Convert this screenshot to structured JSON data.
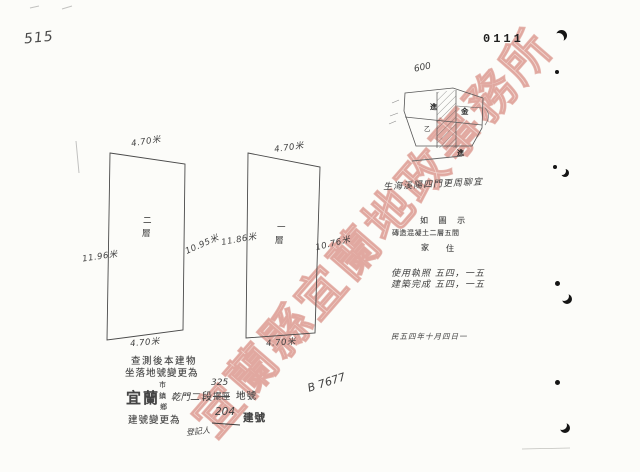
{
  "page": {
    "sheet_number": "515",
    "stamp_number": "0111",
    "ink_color": "#3a3a3a"
  },
  "watermark": {
    "text": "宜蘭縣宜蘭地政事務所",
    "color": "#d98c80"
  },
  "floor_plans": {
    "left": {
      "floor_chars": [
        "二",
        "層"
      ],
      "top": "4.70米",
      "left_side": "11.96米",
      "right_side": "10.95米",
      "bottom": "4.70米"
    },
    "right": {
      "floor_chars": [
        "一",
        "層"
      ],
      "top": "4.70米",
      "left_side": "11.86米",
      "right_side": "10.76米",
      "bottom": "4.70米"
    }
  },
  "site_map": {
    "area_note": "600",
    "labels": {
      "a": "進",
      "b": "金",
      "c": "乙",
      "d": "進"
    },
    "caption": "生海溪陽四門更周聊宜"
  },
  "descriptions": {
    "row1": "如 圖 示",
    "row2": "磚造混凝土二層五間",
    "row3_left": "家",
    "row3_right": "住",
    "date_line1": "使用執照 五四，一五",
    "date_line2": "建築完成 五四，一五",
    "date_line3": "民五四年十月四日一",
    "signature": "B 7677"
  },
  "change_note": {
    "line1": "查測後本建物",
    "line2": "坐落地號變更為",
    "city": "宜蘭",
    "admin_options": [
      "市",
      "鎮",
      "鄉"
    ],
    "section_name": "乾門二",
    "section_word": "段",
    "lot_number": "325",
    "crossed_out": "擺厘",
    "lot_word": "地號",
    "line4": "建號變更為",
    "building_number": "204",
    "building_word": "建號",
    "registrar": "登記人"
  }
}
